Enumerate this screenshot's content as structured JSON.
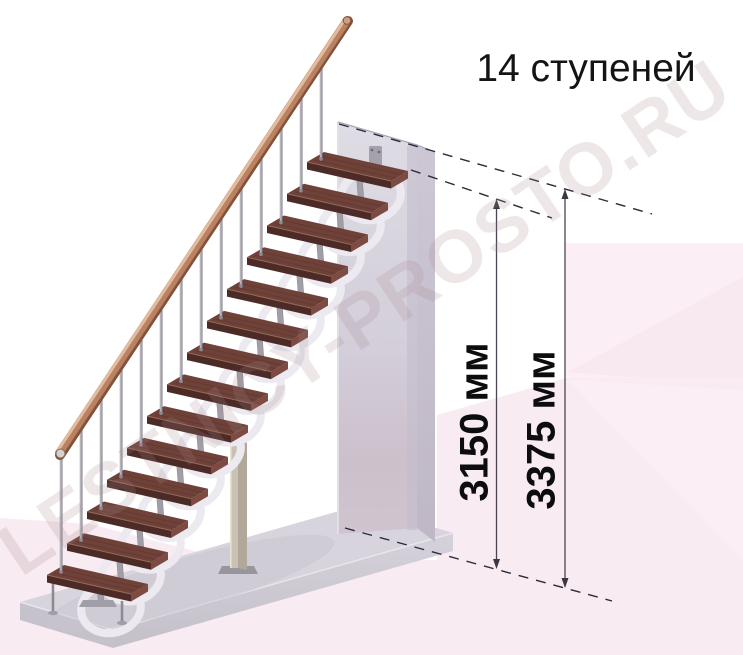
{
  "title": {
    "text": "14 ступеней"
  },
  "watermark": {
    "text": "LESTNICY-PROSTO.RU"
  },
  "dimensions": [
    {
      "label": "3150 мм",
      "value_mm": 3150
    },
    {
      "label": "3375 мм",
      "value_mm": 3375
    }
  ],
  "diagram": {
    "type": "modular-staircase-side-view",
    "step_count": 14,
    "unit": "мм",
    "colors": {
      "tread_top": "#6f4239",
      "tread_grain": "#5c332d",
      "tread_front": "#4c2b26",
      "tread_side": "#7d4b42",
      "tread_edge": "#966a5b",
      "metal": "#a29ea8",
      "metal_dark": "#8e8a94",
      "metal_light": "#eceaf0",
      "branch": "#b0acb4",
      "baluster": "#b5b2b9",
      "baluster_edge": "#7d7a83",
      "rail_body": "#b98263",
      "rail_highlight": "#e3bb9e",
      "rail_shadow": "#84523b",
      "wall_face_top": "#dedce4",
      "wall_face_bottom": "#cbbfca",
      "wall_side": "#c6c0ce",
      "platform_top": "#d8d4dd",
      "platform_front_left": "#c6c2cc",
      "platform_front_right": "#cfcbd5",
      "column_left": "#c9c2b4",
      "column_right": "#b1a899",
      "pink_panel": "#fbeff5",
      "pink_facet": "#f8e6ef",
      "pink_floor": "#f8ecf2",
      "dim_line": "#4a4550",
      "dash_line": "#2f2a38",
      "arrow": "#3b3642",
      "text": "#141414",
      "watermark": "#a5868c"
    }
  }
}
